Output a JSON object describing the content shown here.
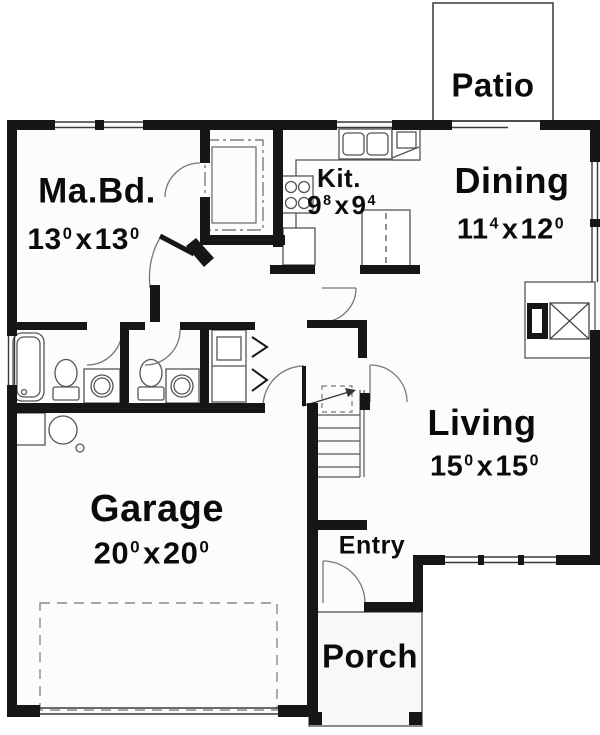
{
  "plan": {
    "separator": "x",
    "colors": {
      "wall": "#161616",
      "fixture_line": "#555555",
      "door_line": "#777777",
      "background": "#ffffff"
    },
    "rooms": {
      "patio": {
        "label": "Patio"
      },
      "master": {
        "label": "Ma.Bd.",
        "dim": {
          "a": "13",
          "asup": "0",
          "b": "13",
          "bsup": "0"
        }
      },
      "kitchen": {
        "label": "Kit.",
        "dim": {
          "a": "9",
          "asup": "8",
          "b": "9",
          "bsup": "4"
        }
      },
      "dining": {
        "label": "Dining",
        "dim": {
          "a": "11",
          "asup": "4",
          "b": "12",
          "bsup": "0"
        }
      },
      "living": {
        "label": "Living",
        "dim": {
          "a": "15",
          "asup": "0",
          "b": "15",
          "bsup": "0"
        }
      },
      "garage": {
        "label": "Garage",
        "dim": {
          "a": "20",
          "asup": "0",
          "b": "20",
          "bsup": "0"
        }
      },
      "entry": {
        "label": "Entry"
      },
      "porch": {
        "label": "Porch"
      }
    }
  }
}
